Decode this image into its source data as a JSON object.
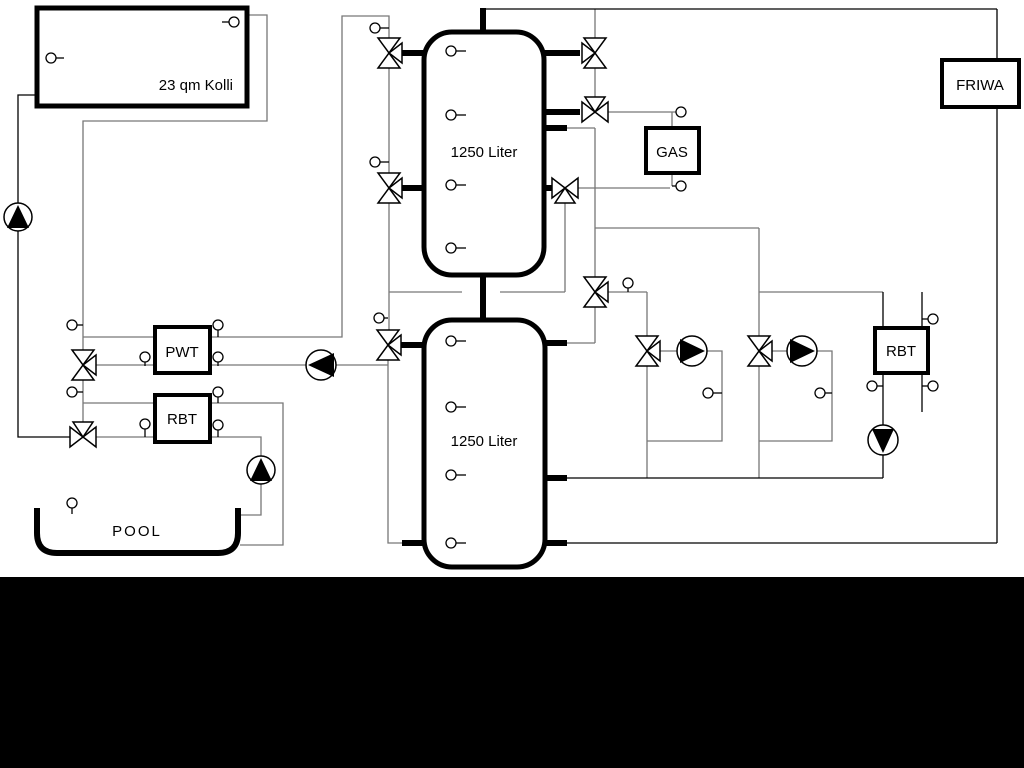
{
  "diagram_title": "Solar heating hydraulic scheme",
  "colors": {
    "line_gray": "#777777",
    "line_black": "#000000",
    "background": "#ffffff",
    "mask": "#000000"
  },
  "components": {
    "collector": {
      "label": "23 qm Kolli"
    },
    "upper_tank": {
      "label": "1250 Liter"
    },
    "lower_tank": {
      "label": "1250 Liter"
    },
    "gas": {
      "label": "GAS"
    },
    "friwa": {
      "label": "FRIWA"
    },
    "pwt": {
      "label": "PWT"
    },
    "rbt_pool": {
      "label": "RBT"
    },
    "rbt_right": {
      "label": "RBT"
    },
    "pool": {
      "label": "POOL"
    }
  }
}
